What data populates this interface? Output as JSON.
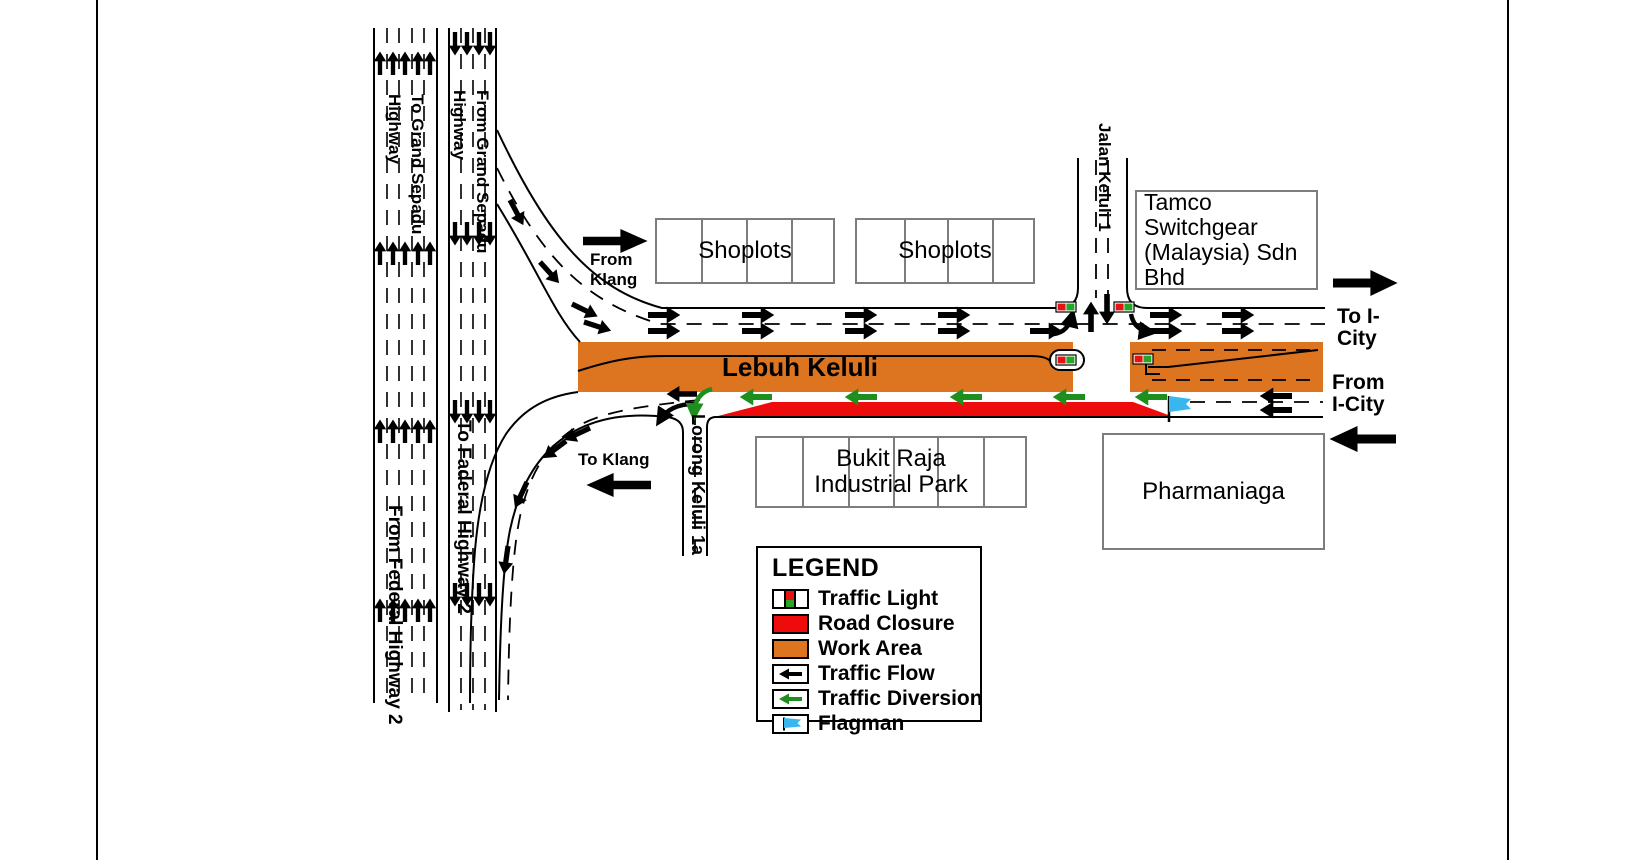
{
  "colors": {
    "work-area": "#DD7420",
    "road-closure": "#EE0B0B",
    "diversion-green": "#1E8F1E",
    "flagman-blue": "#38B6EF",
    "tl-red": "#E81212",
    "tl-green": "#27A527"
  },
  "highways": {
    "to_grand": "To Grand Sepadu Highway",
    "from_grand": "From Grand Sepadu Highway",
    "from_federal": "From Federal Highway 2",
    "to_federal": "To Faderal Highway 2"
  },
  "streets": {
    "lebuh_keluli": "Lebuh Keluli",
    "jalan_keluli": "Jalan Keluli 1",
    "lorong_keluli": "Lorong Keluli 1a"
  },
  "directions": {
    "from_klang": "From Klang",
    "to_klang": "To Klang",
    "to_icity": "To I-City",
    "from_icity": "From I-City"
  },
  "buildings": {
    "shoplots_1": "Shoplots",
    "shoplots_2": "Shoplots",
    "tamco": "Tamco Switchgear (Malaysia) Sdn Bhd",
    "bukit_raja": "Bukit Raja Industrial Park",
    "pharmaniaga": "Pharmaniaga"
  },
  "legend": {
    "title": "LEGEND",
    "items": [
      "Traffic Light",
      "Road Closure",
      "Work Area",
      "Traffic Flow",
      "Traffic Diversion",
      "Flagman"
    ]
  }
}
